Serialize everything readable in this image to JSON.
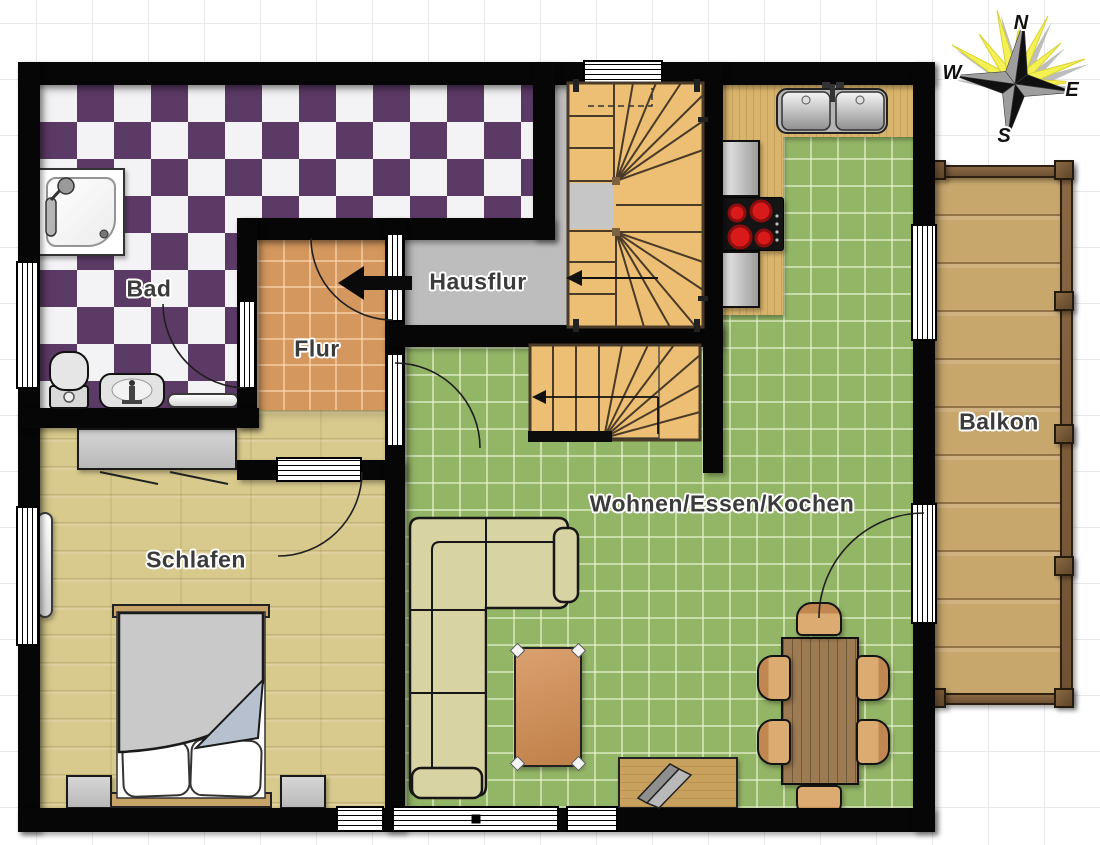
{
  "rooms": {
    "bad": "Bad",
    "flur": "Flur",
    "hausflur": "Hausflur",
    "schlafen": "Schlafen",
    "wohnen": "Wohnen/Essen/Kochen",
    "balkon": "Balkon"
  },
  "compass": {
    "n": "N",
    "e": "E",
    "s": "S",
    "w": "W"
  },
  "colors": {
    "wall": "#060606",
    "bad_tile_purple": "#5b3a66",
    "bad_tile_white": "#f3f2f4",
    "flur_tile": "#d4975e",
    "hausflur_floor": "#bdbdbd",
    "wohnen_tile": "#93b566",
    "schlafen_wood": "#d8ca8d",
    "stairs_wood": "#ecbf74",
    "balkon_wood": "#c8a76d",
    "counter_wood": "#d9b46c",
    "compass_ray_yellow": "#f6f152",
    "burner_red": "#d81a1a"
  }
}
